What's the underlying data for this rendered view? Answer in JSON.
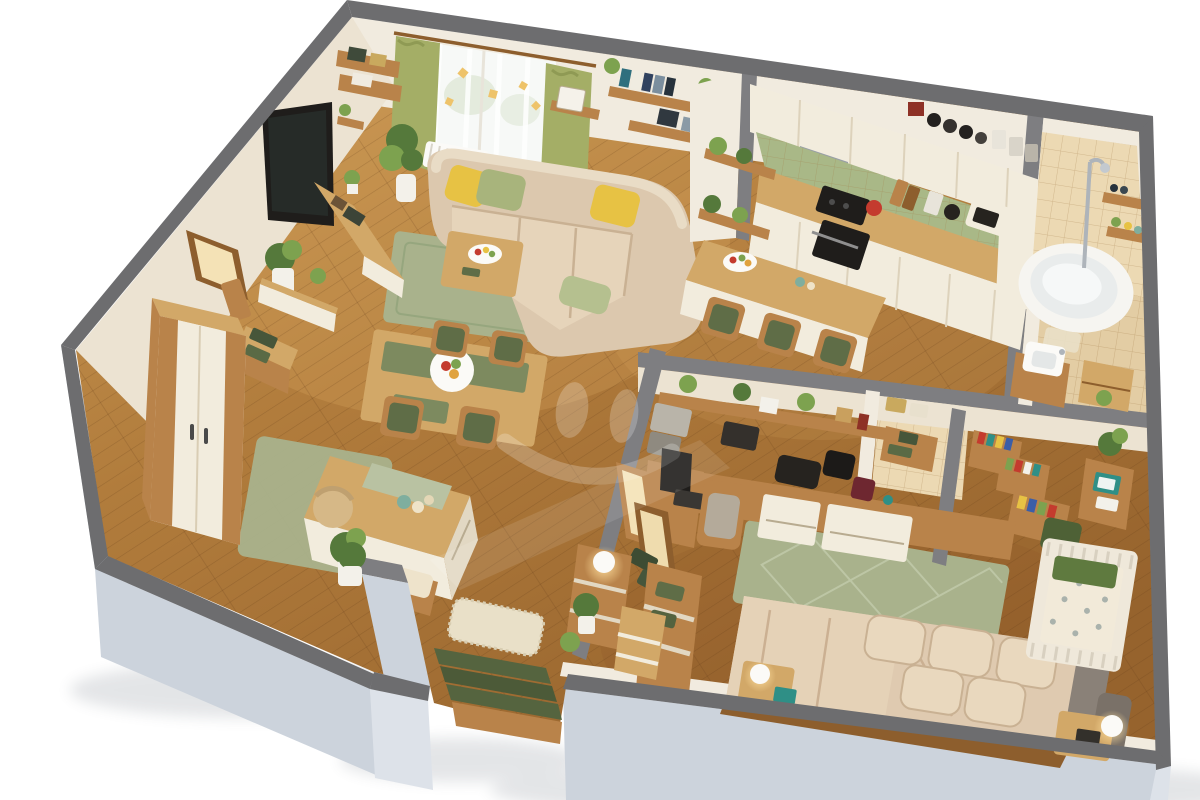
{
  "scene": {
    "type": "3d-isometric-apartment-floor-plan-render",
    "background": "white-studio",
    "walls": "gray-concrete-cutaway",
    "flooring": "oak-plank"
  },
  "palette": {
    "page_bg": "#ffffff",
    "wall_top": "#6d6d6f",
    "wall_top_inner": "#7e7e81",
    "wall_face": "#ccd3dc",
    "wall_face_light": "#dde2e9",
    "inner_wall": "#f1ebdf",
    "inner_wall_warm": "#ece3d2",
    "plank_line": "rgba(92,54,20,0.26)",
    "tile_floor": "#e3cda4",
    "tile_wall": "#ecd9b3",
    "tile_line": "rgba(160,120,70,0.35)",
    "rug_sage": "#a9b28c",
    "rug_sage_dark": "#8f9c74",
    "rug_cream": "#e9e0c8",
    "sofa": "#dcc8ae",
    "sofa_shade": "#c9b193",
    "bed_linen": "#dfcab0",
    "bed_shade": "#cbb092",
    "pillow_yellow": "#e7c244",
    "pillow_green": "#a8b47c",
    "cushion_green": "#5f6d47",
    "stair_green": "#55643f",
    "towel_green": "#47563a",
    "wood": "#b9834a",
    "wood_light": "#d2a868",
    "wood_dark": "#8d5e2d",
    "cream": "#f2ecdd",
    "cream_shade": "#e2d8c3",
    "appliance_black": "#1f1d1b",
    "steel": "#9aa0a6",
    "backsplash": "#a9b887",
    "curtain_green": "#a4ae66",
    "tub_white": "#f6f5f1",
    "porcelain": "#fbfaf7",
    "glow": "#ffe3a8",
    "plant": "#55793b",
    "plant_light": "#7da24f",
    "pot_white": "#f3f1ea",
    "teal": "#2f8f86",
    "red": "#c43b2e",
    "crib_white": "#efe8da",
    "gray_cushion": "#8a8178",
    "watermark": "#ffffff"
  },
  "watermark": {
    "shape": "smiley-face",
    "color": "#ffffff",
    "opacity": 0.22
  },
  "rooms": [
    {
      "name": "living-room",
      "items": [
        "corner-sofa",
        "yellow-pillows",
        "green-pillows",
        "coffee-table",
        "fruit-bowl",
        "sage-rug",
        "wall-tv",
        "media-console",
        "window-green-curtains",
        "sheer-curtains",
        "butterfly-garland",
        "radiator",
        "wall-shelves-books",
        "picture-ledge",
        "tall-mirror",
        "potted-plants",
        "dining-table",
        "chairs-green-pads",
        "table-runner",
        "food-plate",
        "wardrobe",
        "towel-dresser",
        "white-sideboard",
        "island-desk",
        "wicker-chair",
        "cushion-bench"
      ]
    },
    {
      "name": "kitchen",
      "items": [
        "cream-upper-cabinets",
        "cream-lower-cabinets",
        "range-hood",
        "green-tile-backsplash",
        "wood-worktop",
        "black-cooktop",
        "built-in-oven",
        "microwave",
        "coffee-machine",
        "canister-jars",
        "cutting-boards",
        "red-bowl",
        "corner-plant-shelves",
        "dining-table",
        "three-chairs-green-pads",
        "fruit-platter"
      ]
    },
    {
      "name": "bathroom",
      "items": [
        "beige-wall-tiles",
        "tile-floor",
        "corner-bathtub",
        "shower-column",
        "wood-shelves",
        "toiletries",
        "washbasin",
        "wood-vanity",
        "drawer-unit",
        "bath-mat",
        "plant"
      ]
    },
    {
      "name": "utility-closet",
      "items": [
        "tile-floor",
        "wood-bench",
        "green-towels",
        "storage-baskets"
      ]
    },
    {
      "name": "family-bedroom",
      "items": [
        "corner-desk",
        "monitor",
        "keyboard",
        "printers",
        "desk-chair",
        "wall-shelf-plants",
        "drawer-cabinets",
        "black-bags",
        "leaning-mirrors",
        "floor-lamp",
        "sideboard-green-pads",
        "double-bed",
        "beige-duvet",
        "pillows",
        "gray-headboard-cushions",
        "nightstands",
        "table-lamps",
        "teal-books",
        "diamond-sage-rug",
        "white-crib",
        "patterned-crib-mattress",
        "green-crib-blanket",
        "kids-bookshelves",
        "toy-storage",
        "kids-desk-teal-laptop",
        "plants"
      ]
    },
    {
      "name": "hallway",
      "items": [
        "cream-shag-rug",
        "staircase-green-runner",
        "console-table",
        "lit-table-lamp",
        "potted-plants",
        "drawer-dresser"
      ]
    }
  ]
}
